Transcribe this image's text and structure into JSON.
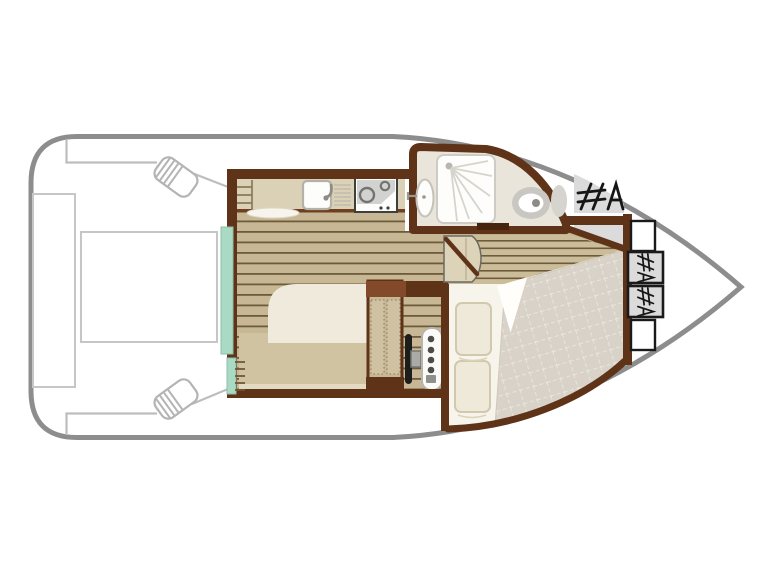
{
  "image": {
    "kind": "boat-floor-plan",
    "description": "Top-down deck plan of a small motor cruiser: aft deck with table and bench, saloon with galley and helm, bathroom, bow cabin with double bed, bow step lockers",
    "width": 768,
    "height": 576
  },
  "colors": {
    "background": "#ffffff",
    "hull_outline": "#8d8d8d",
    "deck_line": "#bdbdbd",
    "wall": "#5f3317",
    "wall_light": "#82492a",
    "floor_wood": "#c7b794",
    "floor_plank_line": "#6d5c3c",
    "steps_wood": "#cbbc9a",
    "counter": "#dbd1b6",
    "counter_edge": "#6f4020",
    "mint_door": "#a9dac4",
    "mint_door_edge": "#8fbfa9",
    "sofa_cream": "#efeadb",
    "seat_khaki": "#d0c3a2",
    "seat_band": "#e3dac2",
    "bathroom_floor": "#e9e5da",
    "fixture_white": "#fdfdfb",
    "fixture_stroke": "#b3b1a9",
    "toilet_ring": "#c9c7c1",
    "cistern_gray": "#d6d4ce",
    "shower_ray": "#d6d4cc",
    "appliance_gray": "#d2d2d0",
    "appliance_dark": "#3f3f3d",
    "quilt": "#d8d2c8",
    "quilt_grid": "#ece8e0",
    "sheet_white": "#f7f4ec",
    "pillow": "#eee9d9",
    "pillow_edge": "#d2c8ae",
    "deck_gray": "#dbdbdb",
    "hatch_black": "#161616",
    "console_white": "#fafaf8",
    "wheel_black": "#1d1d1d",
    "hub_gray": "#aaaaa8",
    "companionway_fill": "#ddd3b8"
  },
  "plan": {
    "rooms": [
      {
        "name": "aft-deck",
        "features": [
          "cockpit-table",
          "side-bench",
          "fender-port",
          "fender-starboard"
        ]
      },
      {
        "name": "saloon-galley",
        "features": [
          "galley-counter",
          "sink",
          "drainer",
          "stove",
          "sofa-berth",
          "wardrobe",
          "helm-station",
          "patio-door"
        ]
      },
      {
        "name": "bathroom",
        "features": [
          "shower",
          "washbasin",
          "toilet"
        ]
      },
      {
        "name": "bow-cabin",
        "features": [
          "double-bed",
          "pillow",
          "pillow",
          "folded-sheet",
          "companionway-steps"
        ]
      },
      {
        "name": "bow-deck",
        "features": [
          "tread-hatch",
          "step-locker",
          "step-locker",
          "tread-hatch"
        ]
      }
    ],
    "fixture_count": {
      "beds": 2,
      "pillows": 2,
      "burners": 2,
      "fenders": 2,
      "bow_lockers": 4,
      "hatch_markings": 3
    }
  }
}
